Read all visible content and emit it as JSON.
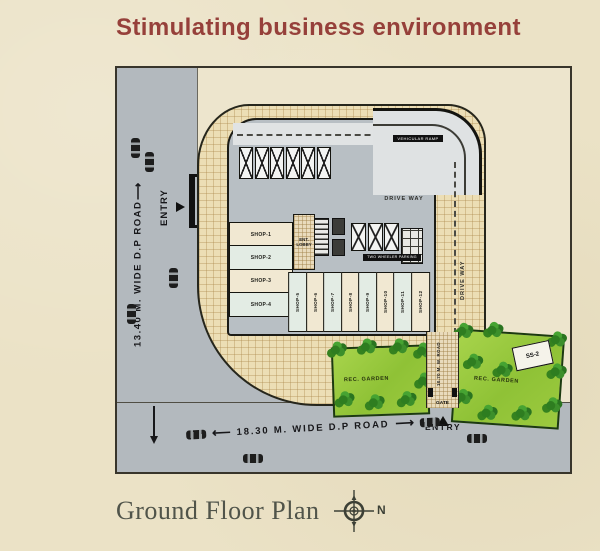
{
  "title": "Stimulating business environment",
  "roads": {
    "left": {
      "label": "13.40 M. WIDE D.P ROAD",
      "arrow": "⟶"
    },
    "bottom": {
      "label": "18.30 M. WIDE D.P ROAD",
      "arrow_left": "⟵",
      "arrow_right": "⟶"
    },
    "side": {
      "label": "10.70 M. W. ROAD"
    }
  },
  "entries": {
    "left": {
      "entry_label": "ENTRY",
      "gate_label": "GATE"
    },
    "bottom": {
      "entry_label": "ENTRY",
      "gate_label": "GATE"
    }
  },
  "building": {
    "driveway_label": "DRIVE WAY",
    "driveway_side_label": "DRIVE WAY",
    "ramp_label": "VEHICULAR RAMP",
    "two_wheeler_label": "TWO WHEELER PARKING",
    "lobby_line1": "ENT.",
    "lobby_line2": "LOBBY",
    "left_shops": [
      "SHOP-1",
      "SHOP-2",
      "SHOP-3",
      "SHOP-4"
    ],
    "bottom_shops": [
      "SHOP-5",
      "SHOP-6",
      "SHOP-7",
      "SHOP-8",
      "SHOP-9",
      "SHOP-10",
      "SHOP-11",
      "SHOP-12"
    ]
  },
  "gardens": {
    "left": {
      "label": "REC. GARDEN"
    },
    "right": {
      "label": "REC. GARDEN",
      "substation_label": "SS-2"
    }
  },
  "footer": {
    "plan_name": "Ground Floor Plan",
    "compass_label": "N"
  },
  "colors": {
    "page_bg": "#ebe2c6",
    "title": "#96403a",
    "road": "#b3b9be",
    "building": "#b8bfc4",
    "shop_cream": "#f1e8d2",
    "shop_green": "#e3ece4",
    "footer_text": "#50544a"
  }
}
